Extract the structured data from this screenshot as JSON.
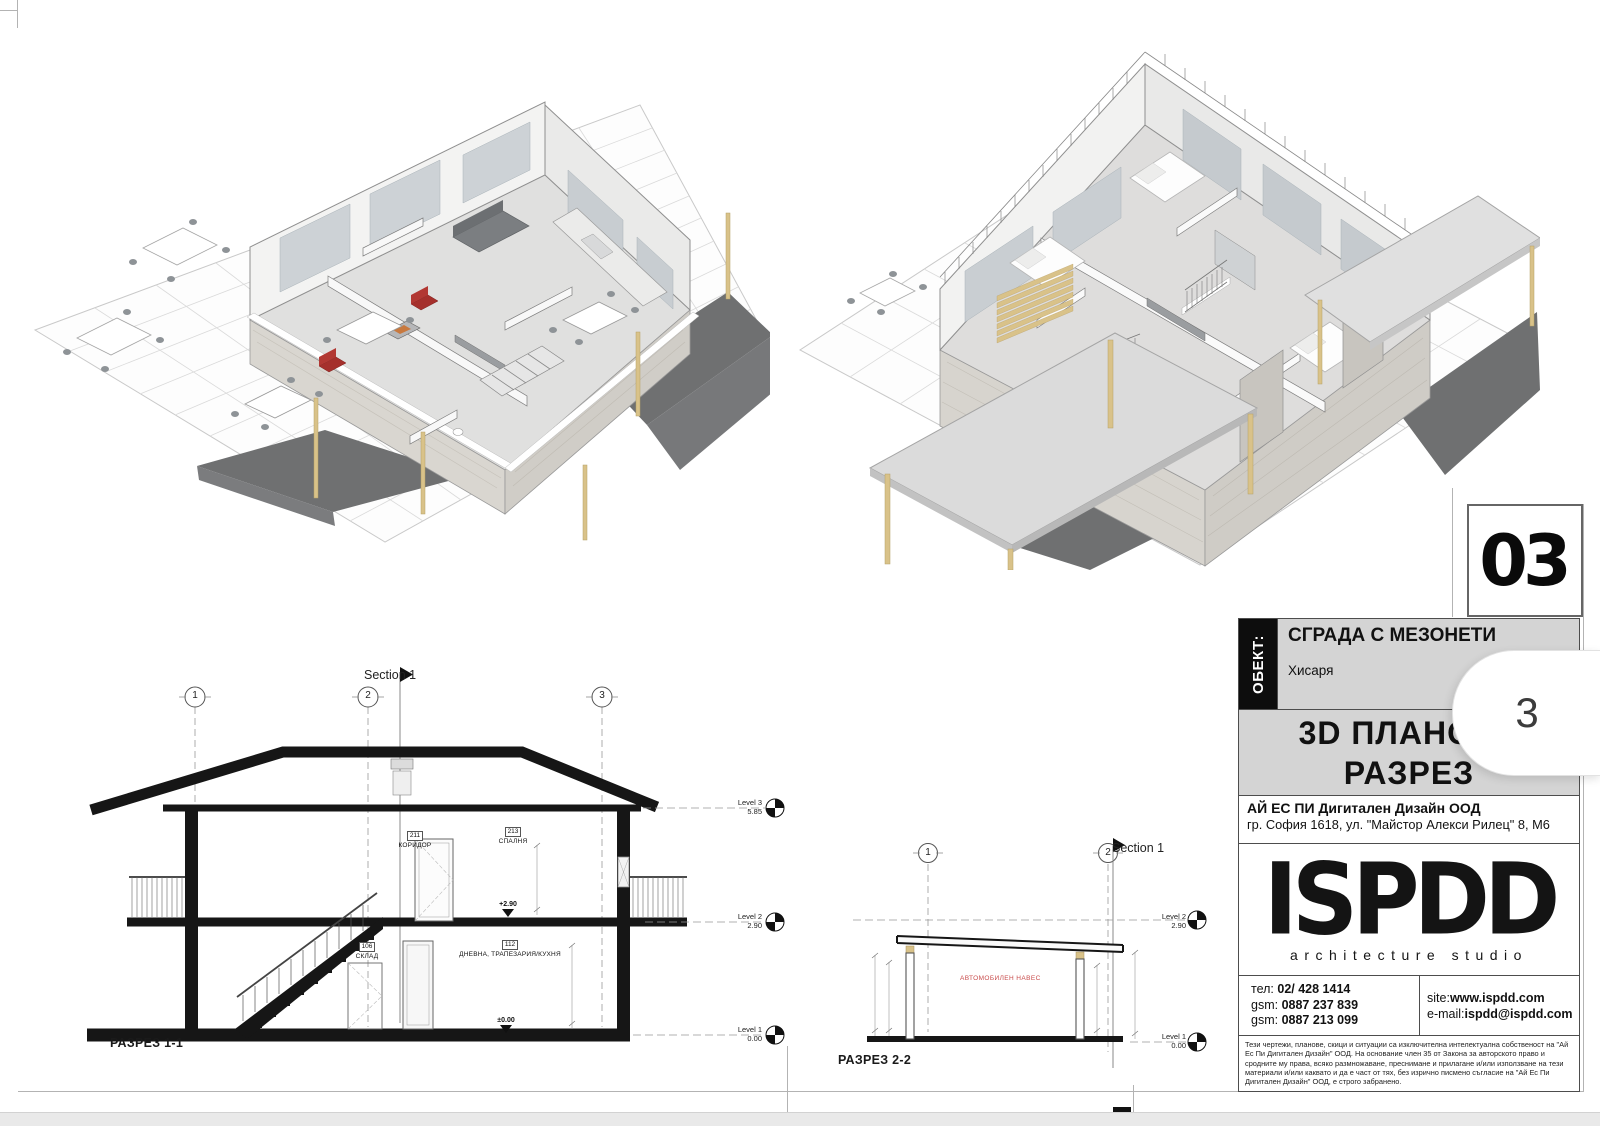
{
  "sheet": {
    "number": "03",
    "page_badge": "3"
  },
  "title_block": {
    "object_label": "ОБЕКТ:",
    "project_name": "СГРАДА С МЕЗОНЕТИ",
    "location": "Хисаря",
    "drawing_title_line1": "3D ПЛАНОВЕ",
    "drawing_title_line2": "РАЗРЕЗ",
    "company_name": "АЙ ЕС ПИ Дигитален Дизайн ООД",
    "company_address": "гр. София 1618, ул. \"Майстор Алекси Рилец\" 8, М6",
    "logo_text": "ISPDD",
    "logo_subtitle": "architecture studio",
    "contacts": {
      "phone_label": "тел:",
      "phone": "02/ 428 1414",
      "gsm1_label": "gsm:",
      "gsm1": "0887 237 839",
      "gsm2_label": "gsm:",
      "gsm2": "0887 213 099",
      "site_label": "site:",
      "site": "www.ispdd.com",
      "email_label": "e-mail:",
      "email": "ispdd@ispdd.com"
    },
    "legal_text": "Тези чертежи, планове, скици и ситуации са изключителна интелектуална собственост на \"Ай Ес Пи Дигитален Дизайн\" ООД. На основание член 35 от Закона за авторското право и сродните му права, всяко размножаване, преснимане и прилагане и/или използване на тези материали и/или каквато и да е част от тях, без изрично писмено съгласие на \"Ай Ес Пи Дигитален Дизайн\" ООД, е строго забранено."
  },
  "section_1_1": {
    "caption": "РАЗРЕЗ 1-1",
    "section_label": "Section 1",
    "grid_bubbles": [
      "1",
      "2",
      "3"
    ],
    "levels": [
      {
        "name": "Level 3",
        "elevation": "5.85"
      },
      {
        "name": "Level 2",
        "elevation": "2.90"
      },
      {
        "name": "Level 1",
        "elevation": "0.00"
      }
    ],
    "rooms": [
      {
        "number": "211",
        "name": "КОРИДОР"
      },
      {
        "number": "213",
        "name": "СПАЛНЯ"
      },
      {
        "number": "112",
        "name": "ДНЕВНА, ТРАПЕЗАРИЯ/КУХНЯ"
      },
      {
        "number": "106",
        "name": "СКЛАД"
      }
    ],
    "spot_elevations": [
      "+2.90",
      "±0.00"
    ]
  },
  "section_2_2": {
    "caption": "РАЗРЕЗ 2-2",
    "section_label": "Section 1",
    "grid_bubbles": [
      "1",
      "2"
    ],
    "levels": [
      {
        "name": "Level 2",
        "elevation": "2.90"
      },
      {
        "name": "Level 1",
        "elevation": "0.00"
      }
    ],
    "red_annotation": "АВТОМОБИЛЕН НАВЕС"
  },
  "colors": {
    "accent_red_chairs": "#a5302c",
    "slab_gray": "#6f7071",
    "post_beige": "#d9c289",
    "panel_gray": "#d4d4d4"
  }
}
